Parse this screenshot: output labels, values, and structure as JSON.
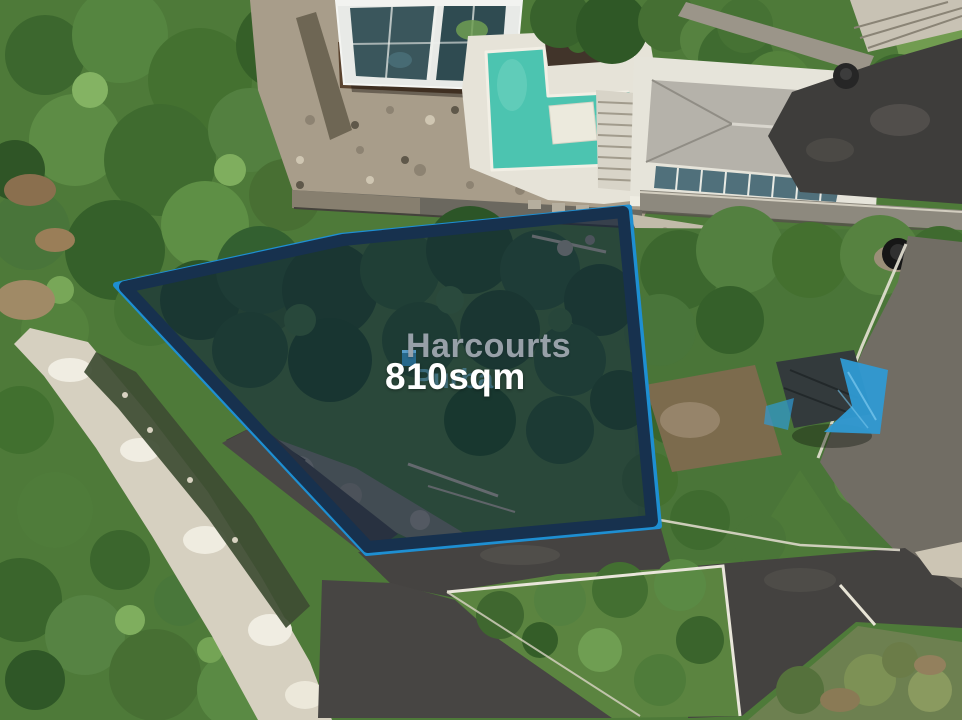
{
  "photo": {
    "description": "Aerial drone photograph of a vacant tropical land plot outlined in blue, with a villa, construction site and swimming pool above, surrounded by roads and dense vegetation",
    "plot": {
      "area_label": "810sqm"
    }
  },
  "branding": {
    "agency": "Harcourts",
    "watermark": "Purba"
  },
  "colors": {
    "plot_outline": "#1e8fd2",
    "plot_outline_dark": "#17314e",
    "plot_fill": "rgba(13,31,60,0.55)",
    "brand_text": "#9ea6af",
    "area_text": "#ffffff",
    "watermark_text": "#6ab2e8",
    "pool_water": "#4cc4b0",
    "tarp_blue": "#2f9ad3",
    "asphalt": "#454341",
    "vegetation": "#4e7a39"
  }
}
